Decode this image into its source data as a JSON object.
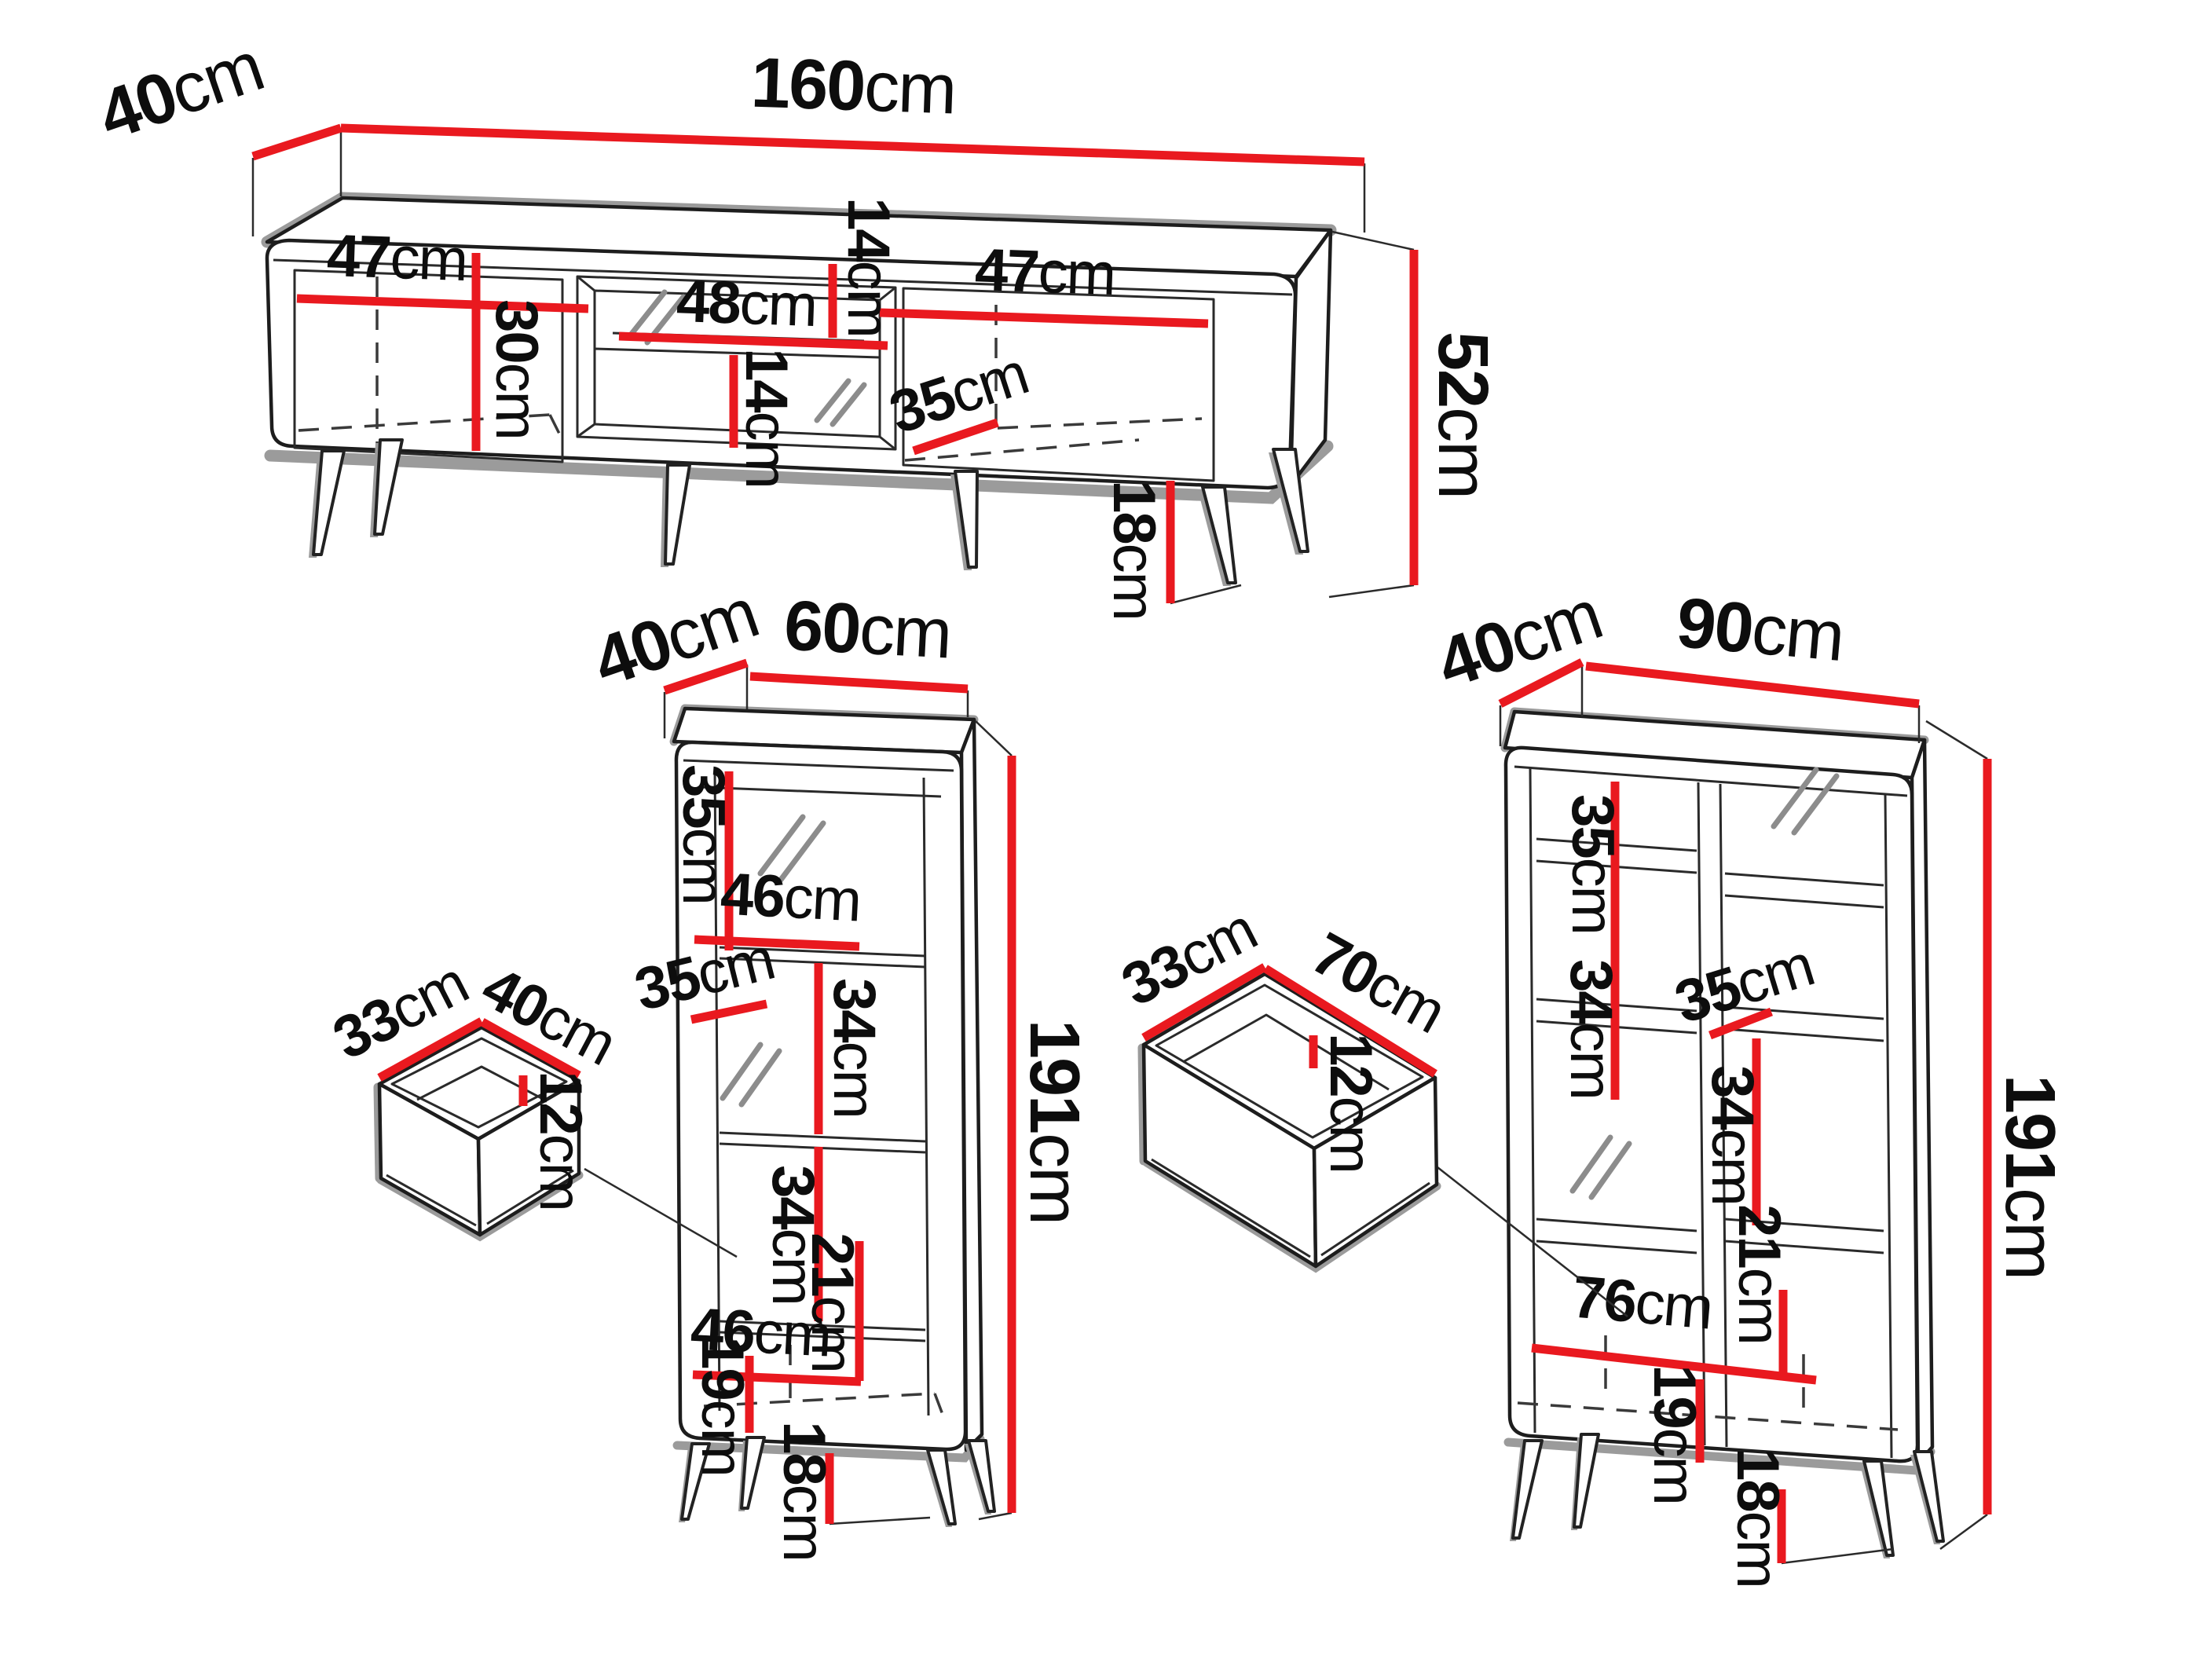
{
  "colors": {
    "dimension_line": "#e9191f",
    "outline": "#1d1d1d",
    "shadow": "#9b9b9b",
    "background": "#ffffff"
  },
  "p": {
    "tv": {
      "depth": {
        "v": "40",
        "u": "cm"
      },
      "width": {
        "v": "160",
        "u": "cm"
      },
      "height": {
        "v": "52",
        "u": "cm"
      },
      "leg": {
        "v": "18",
        "u": "cm"
      },
      "door_l_w": {
        "v": "47",
        "u": "cm"
      },
      "door_l_h": {
        "v": "30",
        "u": "cm"
      },
      "niche_top_h": {
        "v": "14",
        "u": "cm"
      },
      "niche_w": {
        "v": "48",
        "u": "cm"
      },
      "niche_bot_h": {
        "v": "14",
        "u": "cm"
      },
      "door_r_w": {
        "v": "47",
        "u": "cm"
      },
      "inner_depth": {
        "v": "35",
        "u": "cm"
      }
    },
    "c60": {
      "depth": {
        "v": "40",
        "u": "cm"
      },
      "width": {
        "v": "60",
        "u": "cm"
      },
      "height": {
        "v": "191",
        "u": "cm"
      },
      "s1_h": {
        "v": "35",
        "u": "cm"
      },
      "shelf_w": {
        "v": "46",
        "u": "cm"
      },
      "s2_h": {
        "v": "34",
        "u": "cm"
      },
      "shelf_d": {
        "v": "35",
        "u": "cm"
      },
      "s3_h": {
        "v": "34",
        "u": "cm"
      },
      "lower_w": {
        "v": "46",
        "u": "cm"
      },
      "lower_h": {
        "v": "21",
        "u": "cm"
      },
      "bottom_h": {
        "v": "19",
        "u": "cm"
      },
      "leg": {
        "v": "18",
        "u": "cm"
      }
    },
    "ds": {
      "depth": {
        "v": "33",
        "u": "cm"
      },
      "width": {
        "v": "40",
        "u": "cm"
      },
      "height": {
        "v": "12",
        "u": "cm"
      }
    },
    "c90": {
      "depth": {
        "v": "40",
        "u": "cm"
      },
      "width": {
        "v": "90",
        "u": "cm"
      },
      "height": {
        "v": "191",
        "u": "cm"
      },
      "left_s1": {
        "v": "35",
        "u": "cm"
      },
      "left_s2": {
        "v": "34",
        "u": "cm"
      },
      "shelf_d": {
        "v": "35",
        "u": "cm"
      },
      "right_s": {
        "v": "34",
        "u": "cm"
      },
      "lower_w": {
        "v": "76",
        "u": "cm"
      },
      "lower_h": {
        "v": "21",
        "u": "cm"
      },
      "bottom_h": {
        "v": "19",
        "u": "cm"
      },
      "leg": {
        "v": "18",
        "u": "cm"
      }
    },
    "dl": {
      "depth": {
        "v": "33",
        "u": "cm"
      },
      "width": {
        "v": "70",
        "u": "cm"
      },
      "height": {
        "v": "12",
        "u": "cm"
      }
    }
  }
}
